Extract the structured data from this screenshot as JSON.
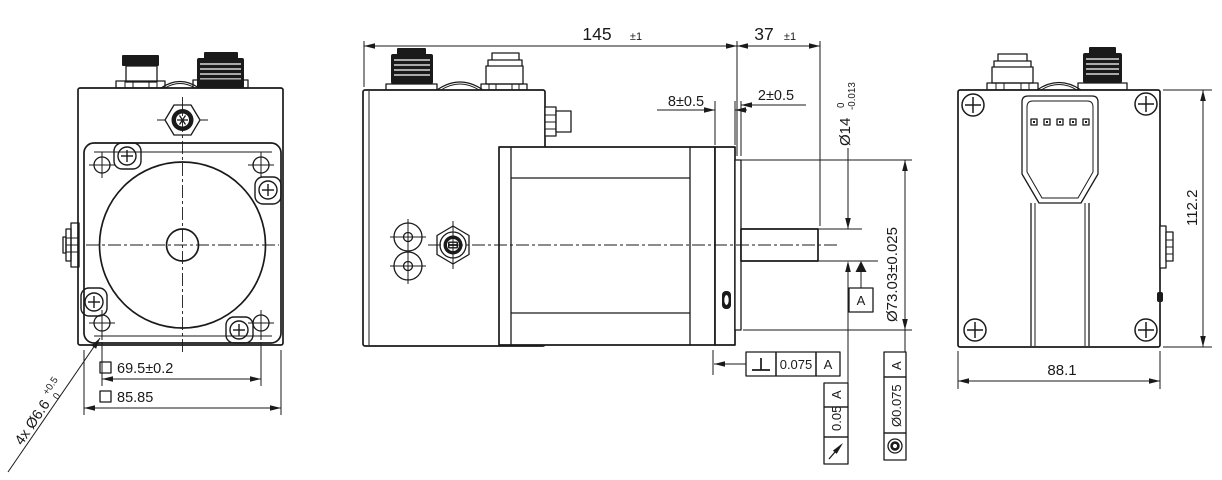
{
  "front_view": {
    "bolt_circle_dim": "69.5±0.2",
    "flange_square_dim": "85.85",
    "mounting_holes_label": "4x Ø6.6",
    "mounting_holes_tol_upper": "+0.5",
    "mounting_holes_tol_lower": "0"
  },
  "side_view": {
    "overall_length_dim": "145",
    "overall_length_tol": "±1",
    "shaft_length_dim": "37",
    "shaft_length_tol": "±1",
    "flange_thickness_dim": "8±0.5",
    "pilot_depth_dim": "2±0.5",
    "shaft_diameter_dim": "Ø14",
    "shaft_diameter_tol_upper": "0",
    "shaft_diameter_tol_lower": "-0.013",
    "pilot_diameter_dim": "Ø73.03±0.025",
    "datum_label": "A",
    "perpendicularity": {
      "tolerance": "0.075",
      "datum": "A"
    },
    "runout": {
      "tolerance": "0.05",
      "datum": "A"
    },
    "concentricity": {
      "tolerance": "Ø0.075",
      "datum": "A"
    }
  },
  "back_view": {
    "height_dim": "112.2",
    "width_dim": "88.1",
    "led_count": 5
  },
  "colors": {
    "line": "#1a1a1a",
    "background": "#ffffff"
  }
}
